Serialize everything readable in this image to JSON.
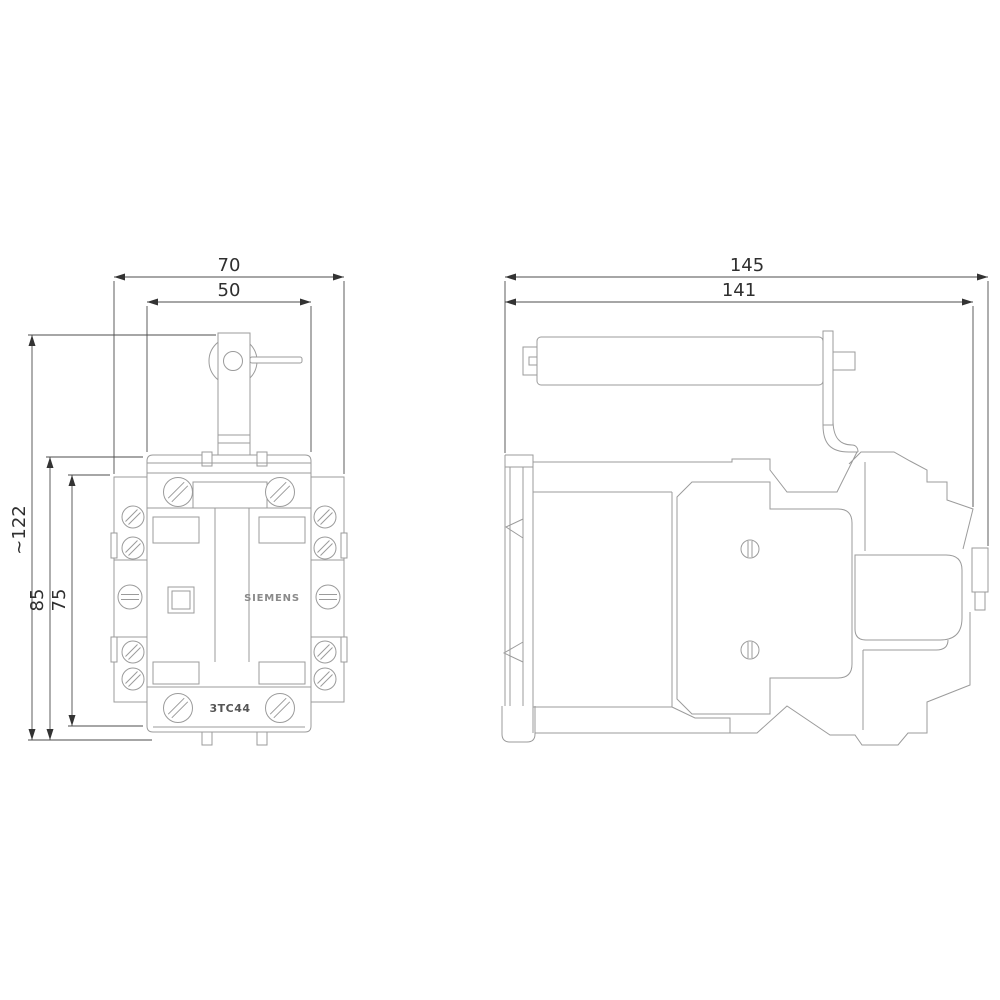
{
  "drawing_type": "technical-dimension-drawing",
  "product": {
    "brand": "SIEMENS",
    "model": "3TC44"
  },
  "colors": {
    "background": "#ffffff",
    "body_lines": "#9b9b9b",
    "dimension_lines": "#4d4d4d",
    "text": "#2f2f2f"
  },
  "views": {
    "front": {
      "name": "front-view",
      "dims": {
        "outer_width": "70",
        "cover_width": "50",
        "overall_height": "~122",
        "body_height": "85",
        "inner_height": "75"
      }
    },
    "side": {
      "name": "side-view",
      "dims": {
        "overall_depth": "145",
        "body_depth": "141"
      }
    }
  }
}
